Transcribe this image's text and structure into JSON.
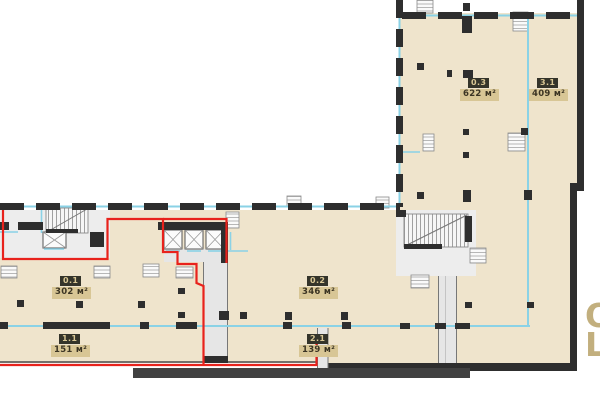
{
  "floorplan": {
    "rooms": [
      {
        "id": "0.1",
        "area": "302 м²"
      },
      {
        "id": "1.1",
        "area": "151 м²"
      },
      {
        "id": "0.2",
        "area": "346 м²"
      },
      {
        "id": "2.1",
        "area": "139 м²"
      },
      {
        "id": "0.3",
        "area": "622 м²"
      },
      {
        "id": "3.1",
        "area": "409 м²"
      }
    ],
    "edge_text": {
      "line1": "O",
      "line2": "L"
    },
    "colors": {
      "floor": "#efe4cc",
      "walls": "#2e2e2e",
      "lease_boundary_red": "#e8221c",
      "utility_cyan": "#8ad2e6",
      "label_chip_bg": "#34342a",
      "label_chip_text": "#d9c795",
      "label_area_bg": "#d8c695",
      "label_area_text": "#3b3423",
      "edge_text_color": "#c2af7e"
    }
  }
}
